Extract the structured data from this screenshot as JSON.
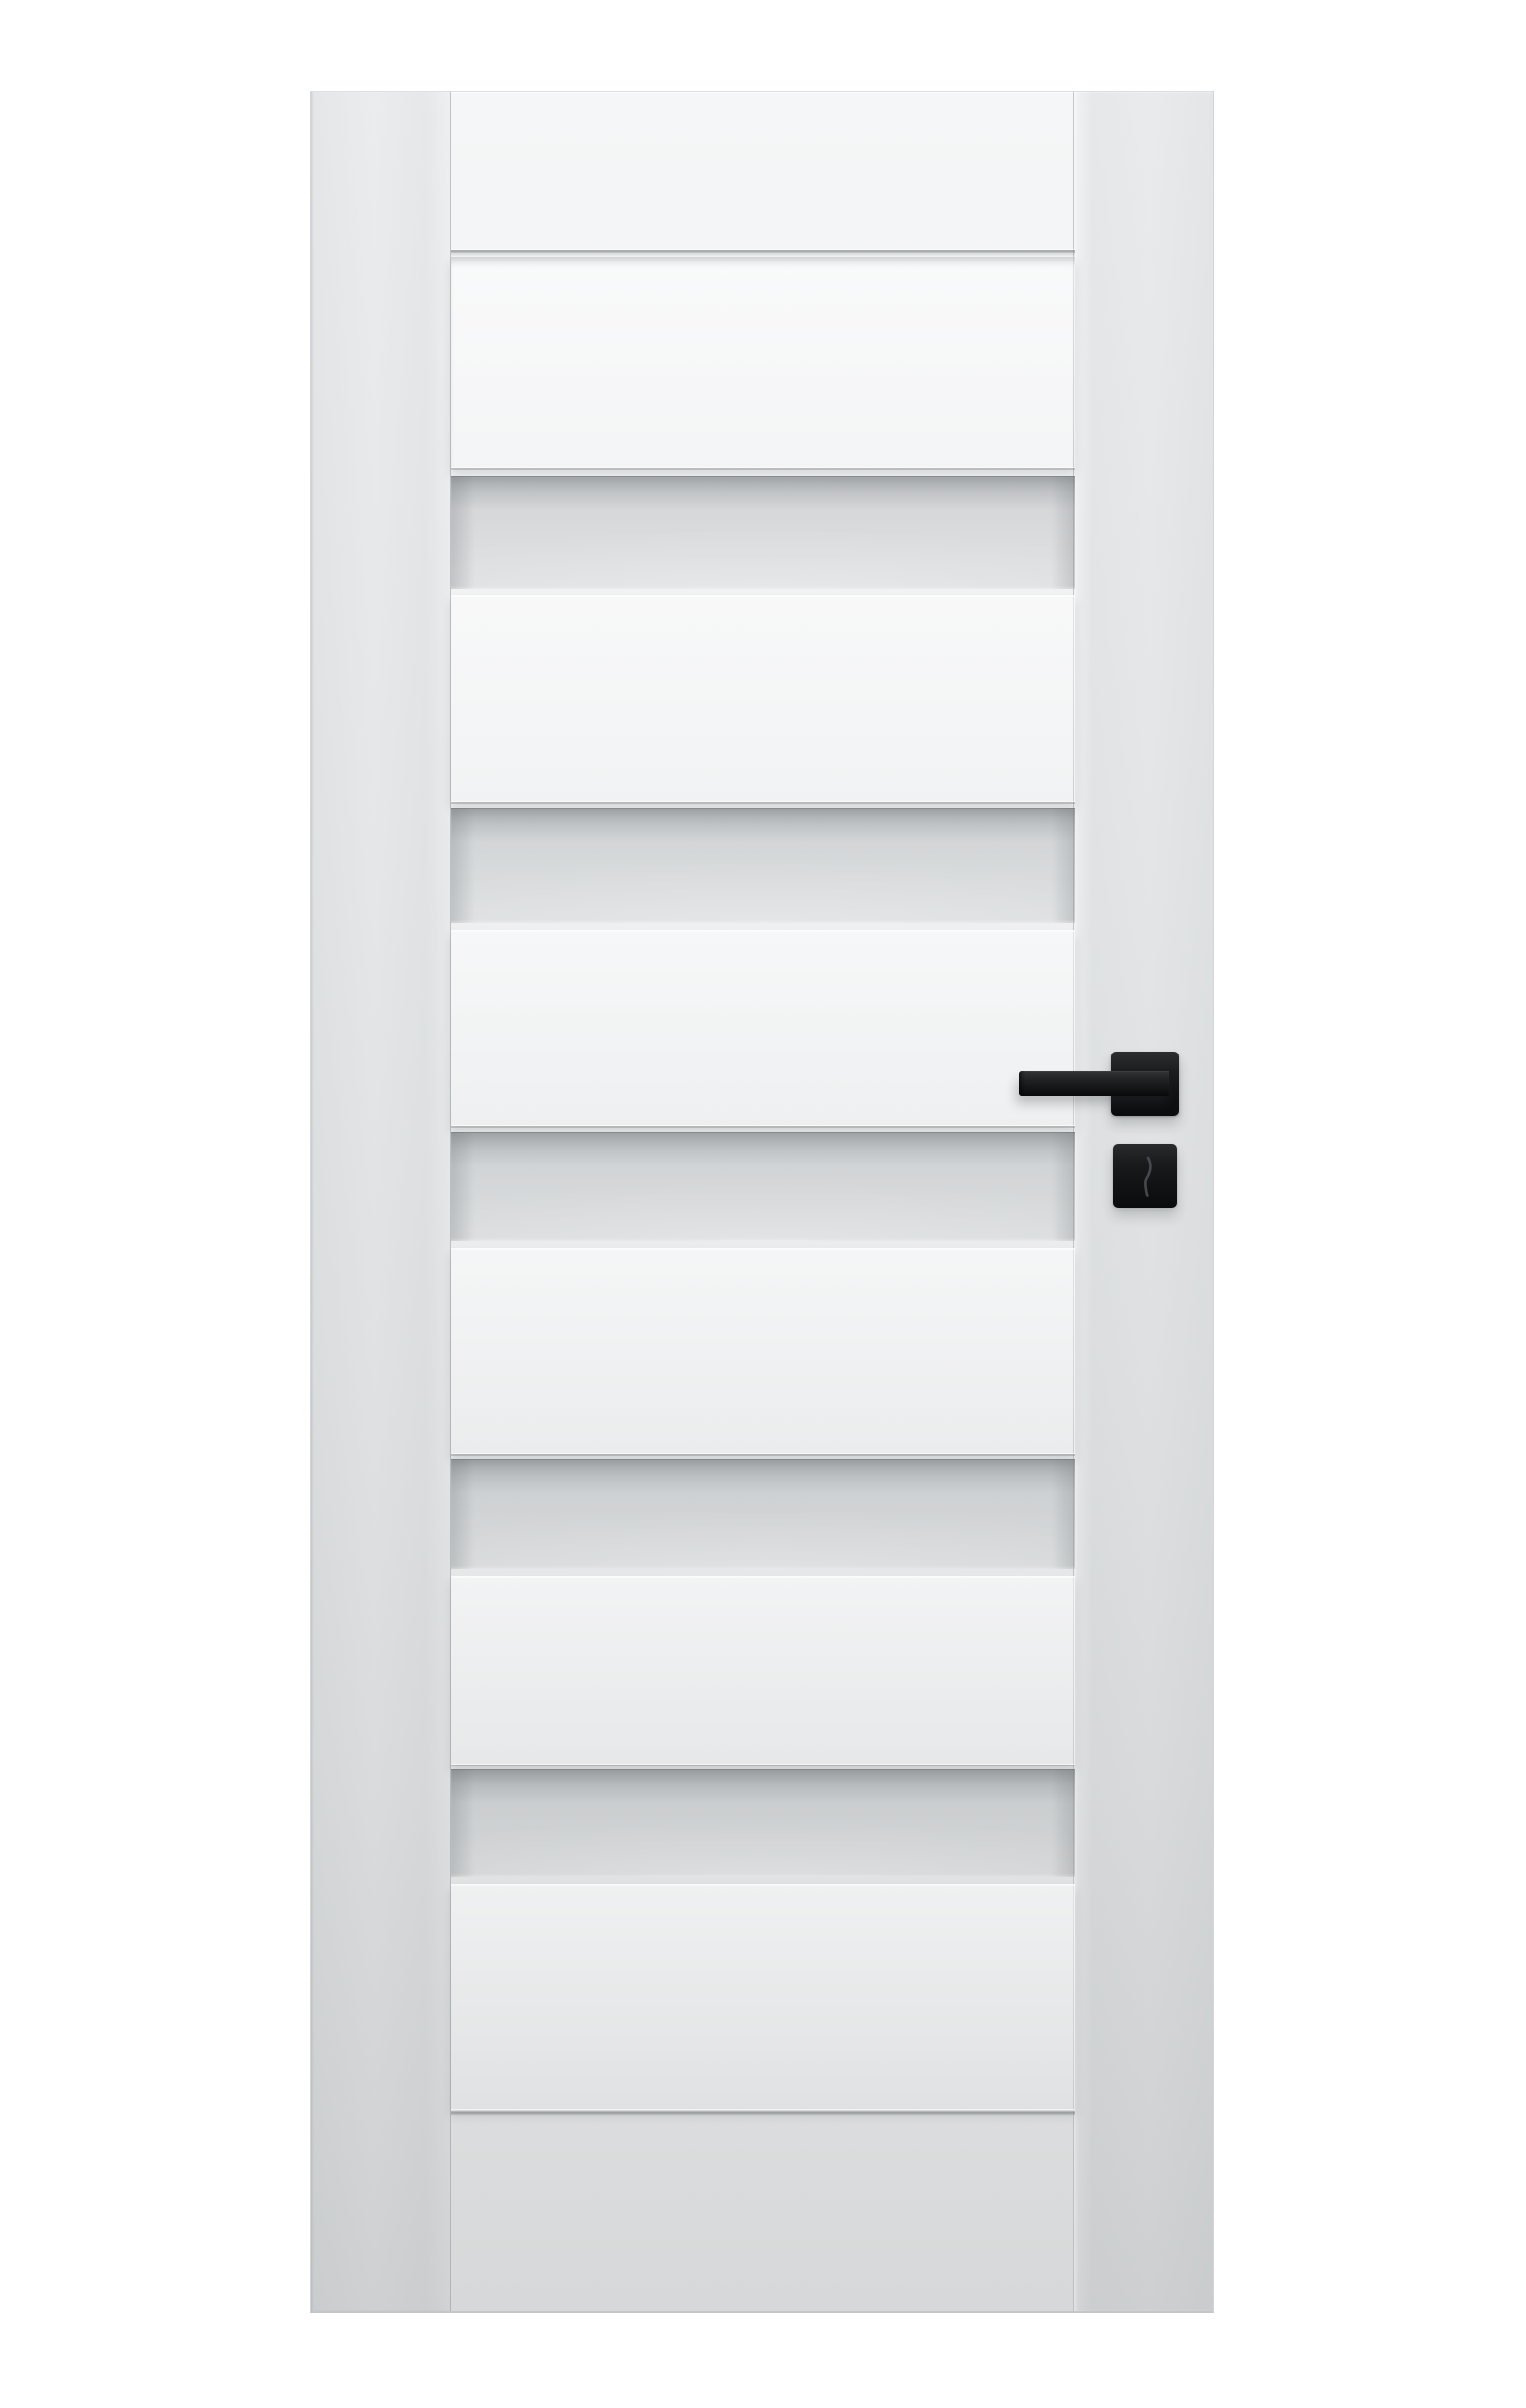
{
  "photo": {
    "label": "Product photo of a white interior door on a white background",
    "background_color": "#ffffff"
  },
  "door": {
    "label": "White interior door with six raised horizontal panels alternating with five frosted glass strips",
    "door_color": "#f2f3f4",
    "glass_color": "#d5d7d9",
    "panel_count": "6",
    "glass_strip_count": "5",
    "parts": {
      "left_stile_label": "Left stile",
      "right_stile_label": "Right stile",
      "top_rail_label": "Top rail",
      "bottom_rail_label": "Bottom rail",
      "panel_label": "Raised panel",
      "glass_label": "Frosted glass strip"
    }
  },
  "hardware": {
    "label": "Matte black door handle set: straight lever on square rosette with separate square keyhole escutcheon below",
    "color": "#121416",
    "lever_label": "Lever handle",
    "rosette_label": "Square rosette",
    "escutcheon_label": "Keyhole escutcheon"
  }
}
